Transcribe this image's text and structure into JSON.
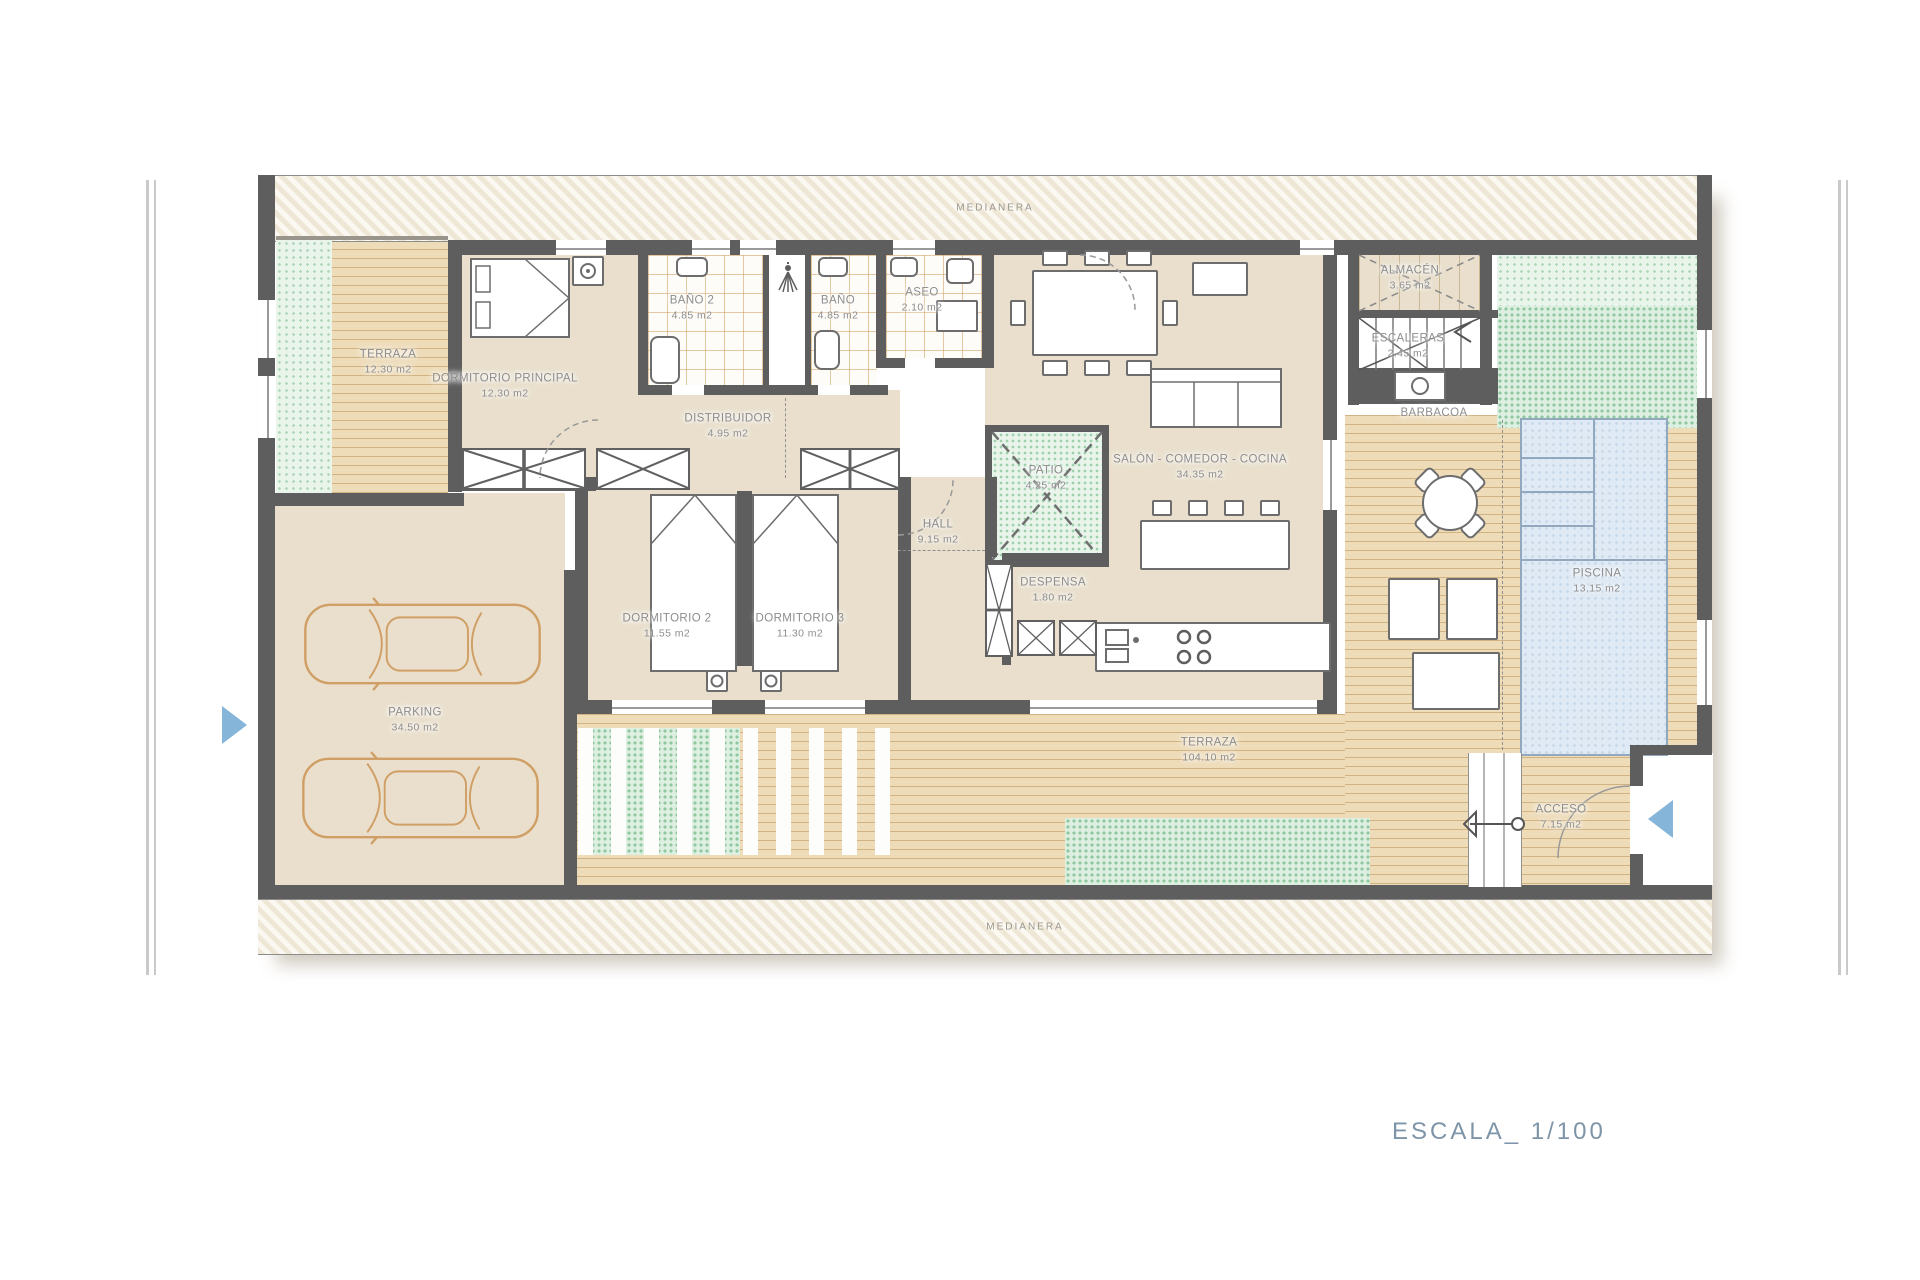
{
  "title_block": {
    "scale_label": "ESCALA_ 1/100"
  },
  "party_walls": {
    "top": "MEDIANERA",
    "bottom": "MEDIANERA"
  },
  "rooms": [
    {
      "id": "terraza-small",
      "label": "TERRAZA",
      "area": "12.30 m2",
      "x": 388,
      "y": 362
    },
    {
      "id": "dormitorio-principal",
      "label": "DORMITORIO PRINCIPAL",
      "area": "12.30 m2",
      "x": 505,
      "y": 386
    },
    {
      "id": "bano-2",
      "label": "BAÑO 2",
      "area": "4.85 m2",
      "x": 692,
      "y": 308
    },
    {
      "id": "bano",
      "label": "BAÑO",
      "area": "4.85 m2",
      "x": 838,
      "y": 308
    },
    {
      "id": "aseo",
      "label": "ASEO",
      "area": "2.10 m2",
      "x": 922,
      "y": 300
    },
    {
      "id": "distribuidor",
      "label": "DISTRIBUIDOR",
      "area": "4.95 m2",
      "x": 728,
      "y": 426
    },
    {
      "id": "hall",
      "label": "HALL",
      "area": "9.15 m2",
      "x": 938,
      "y": 532
    },
    {
      "id": "patio",
      "label": "PATIO",
      "area": "4.25 m2",
      "x": 1046,
      "y": 478
    },
    {
      "id": "salon-comedor-cocina",
      "label": "SALÓN - COMEDOR - COCINA",
      "area": "34.35 m2",
      "x": 1200,
      "y": 467
    },
    {
      "id": "almacen",
      "label": "ALMACÉN",
      "area": "3.65 m2",
      "x": 1410,
      "y": 278
    },
    {
      "id": "escaleras",
      "label": "ESCALERAS",
      "area": "2.45 m2",
      "x": 1408,
      "y": 346
    },
    {
      "id": "barbacoa",
      "label": "BARBACOA",
      "area": "",
      "x": 1434,
      "y": 413
    },
    {
      "id": "piscina",
      "label": "PISCINA",
      "area": "13.15 m2",
      "x": 1597,
      "y": 581
    },
    {
      "id": "despensa",
      "label": "DESPENSA",
      "area": "1.80 m2",
      "x": 1053,
      "y": 590
    },
    {
      "id": "dormitorio-2",
      "label": "DORMITORIO 2",
      "area": "11.55 m2",
      "x": 667,
      "y": 626
    },
    {
      "id": "dormitorio-3",
      "label": "DORMITORIO 3",
      "area": "11.30 m2",
      "x": 800,
      "y": 626
    },
    {
      "id": "parking",
      "label": "PARKING",
      "area": "34.50 m2",
      "x": 415,
      "y": 720
    },
    {
      "id": "terraza-big",
      "label": "TERRAZA",
      "area": "104.10 m2",
      "x": 1209,
      "y": 750
    },
    {
      "id": "acceso",
      "label": "ACCESO",
      "area": "7.15 m2",
      "x": 1561,
      "y": 817
    }
  ],
  "colors": {
    "wall": "#5e5e5e",
    "floor_beige": "#e9dfcc",
    "deck": "#eedcb9",
    "deck_line": "#c9a874",
    "green_dot": "#8fc79e",
    "pool_fill": "#dfeaf5",
    "pool_border": "#91a8bf",
    "label_text": "#8d8d8d",
    "entry_arrow_blue": "#85b5d8",
    "car_outline": "#cf9f66",
    "scale_text": "#7e94a8"
  }
}
